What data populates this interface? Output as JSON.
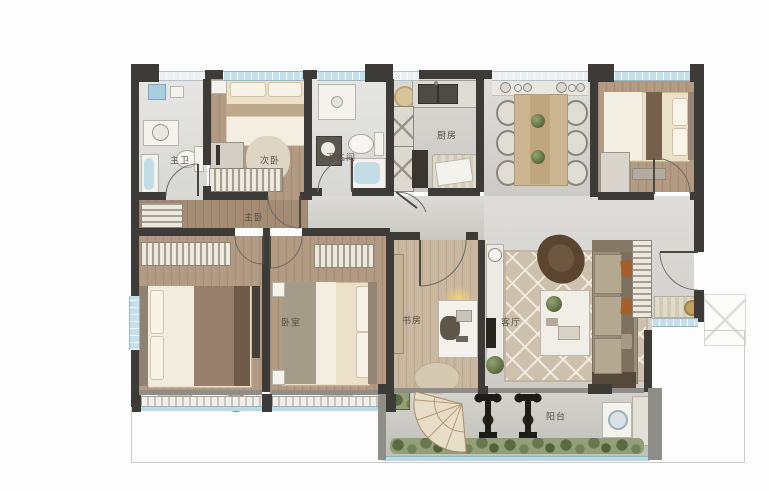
{
  "plan_labels": {
    "master_bath": "主卫",
    "secondary_bedroom": "次卧",
    "bathroom": "卫生间",
    "kitchen": "厨房",
    "master_bedroom": "主卧",
    "bedroom": "卧室",
    "study": "书房",
    "living_room": "客厅",
    "balcony": "阳台"
  },
  "colors": {
    "wall": "#3c3b37",
    "wood_floor": "#b29a83",
    "tile_floor": "#d2d1cd",
    "window_glass": "#c3e0ec",
    "greenery": "#6d7d50",
    "bed_linen": "#ebe1c9",
    "living_rug": "#cdc1ae",
    "accent_cushion": "#a3602e",
    "label_text": "#53514b"
  },
  "furniture_icons": [
    "double-bed",
    "wardrobe",
    "nightstand",
    "dresser",
    "vanity-sink",
    "toilet",
    "bathtub",
    "shower",
    "kitchen-double-sink",
    "refrigerator-cabinet",
    "dining-table",
    "dining-chair",
    "bar-glassware",
    "sofa",
    "lounge-armchair",
    "coffee-table",
    "tv",
    "area-rug",
    "desk",
    "desk-chair",
    "desk-lamp",
    "potted-plant",
    "shoe-cabinet",
    "doormat",
    "washing-machine",
    "exercise-bike",
    "fan-mosaic",
    "planter-greenery",
    "air-conditioner-platform"
  ]
}
